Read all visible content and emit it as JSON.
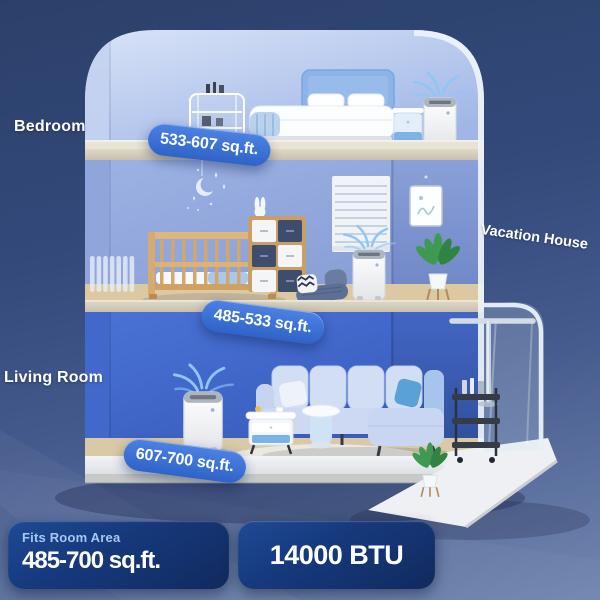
{
  "labels": {
    "bedroom": "Bedroom",
    "living_room": "Living Room",
    "house": "Vacation House"
  },
  "area_badges": {
    "bedroom": "533-607 sq.ft.",
    "kids_room": "485-533 sq.ft.",
    "living_room": "607-700 sq.ft."
  },
  "footer": {
    "area_card": {
      "caption": "Fits Room Area",
      "value": "485-700 sq.ft."
    },
    "btu_card": {
      "value": "14000 BTU"
    }
  },
  "colors": {
    "background_top": "#2b4069",
    "background_mid": "#44598c",
    "background_bottom": "#7186af",
    "area_badge_top": "#4c82e4",
    "area_badge_bottom": "#2f63c8",
    "stat_card_top": "#1f4a94",
    "stat_card_bottom": "#112a5e",
    "caption_text": "#a6c8f4",
    "text": "#ffffff",
    "wall_bedroom": "#b9caee",
    "wall_kids": "#8fa7dd",
    "wall_living": "#3f68cd",
    "airflow": "#8ec7f5"
  }
}
